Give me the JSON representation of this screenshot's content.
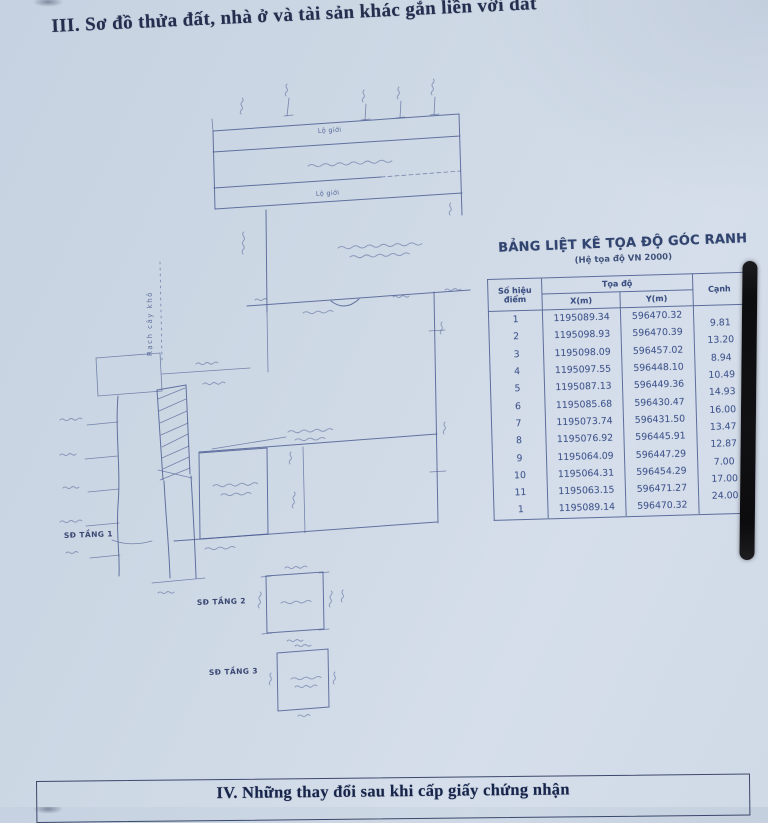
{
  "page": {
    "section_iii_title": "III. Sơ đồ thửa đất, nhà ở và tài sản khác gắn liền với đất",
    "section_iv_title": "IV. Những thay đổi sau khi cấp giấy chứng nhận"
  },
  "coordinate_table": {
    "title": "BẢNG LIỆT KÊ TỌA ĐỘ GÓC RANH",
    "subtitle": "(Hệ tọa độ VN 2000)",
    "headers": {
      "point": "Số hiệu điểm",
      "coords": "Tọa độ",
      "x": "X(m)",
      "y": "Y(m)",
      "edge": "Cạnh"
    },
    "rows": [
      {
        "point": "1",
        "x": "1195089.34",
        "y": "596470.32",
        "edge": "9.81"
      },
      {
        "point": "2",
        "x": "1195098.93",
        "y": "596470.39",
        "edge": "13.20"
      },
      {
        "point": "3",
        "x": "1195098.09",
        "y": "596457.02",
        "edge": "8.94"
      },
      {
        "point": "4",
        "x": "1195097.55",
        "y": "596448.10",
        "edge": "10.49"
      },
      {
        "point": "5",
        "x": "1195087.13",
        "y": "596449.36",
        "edge": "14.93"
      },
      {
        "point": "6",
        "x": "1195085.68",
        "y": "596430.47",
        "edge": "16.00"
      },
      {
        "point": "7",
        "x": "1195073.74",
        "y": "596431.50",
        "edge": "13.47"
      },
      {
        "point": "8",
        "x": "1195076.92",
        "y": "596445.91",
        "edge": "12.87"
      },
      {
        "point": "9",
        "x": "1195064.09",
        "y": "596447.29",
        "edge": "7.00"
      },
      {
        "point": "10",
        "x": "1195064.31",
        "y": "596454.29",
        "edge": "17.00"
      },
      {
        "point": "11",
        "x": "1195063.15",
        "y": "596471.27",
        "edge": "24.00"
      },
      {
        "point": "1",
        "x": "1195089.14",
        "y": "596470.32",
        "edge": ""
      }
    ]
  },
  "diagram": {
    "road_label_top": "Lộ giới",
    "road_label_bottom": "Lộ giới",
    "canal_label": "Rạch cây khô",
    "floor_plan_labels": [
      "SĐ TẦNG 1",
      "SĐ TẦNG 2",
      "SĐ TẦNG 3"
    ]
  },
  "colors": {
    "paper": "#ccd7e4",
    "map_ink": "#4e5e93",
    "table_ink": "#3c4f82",
    "title_ink": "#242e4e",
    "binding_bar": "#111113"
  }
}
